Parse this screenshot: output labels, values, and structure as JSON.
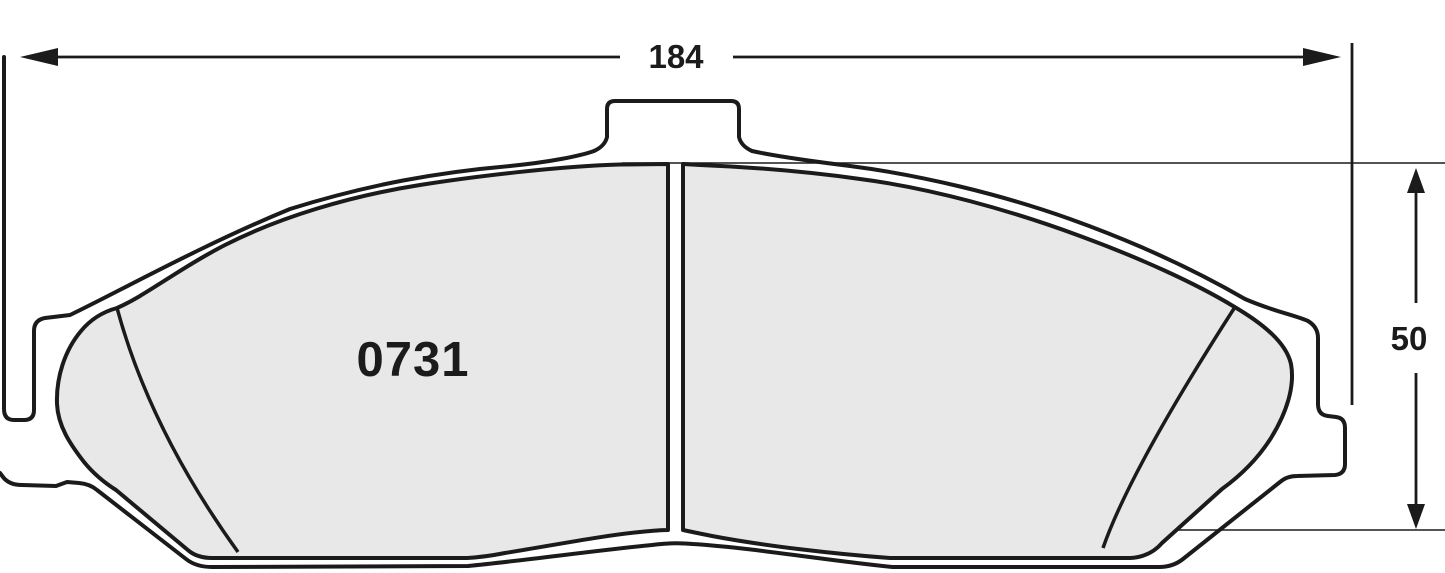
{
  "diagram": {
    "title": "brake-pad-technical-drawing",
    "part_number": "0731",
    "width_dimension": {
      "label": "184"
    },
    "height_dimension": {
      "label": "50"
    }
  },
  "colors": {
    "line": "#1b1b1b",
    "friction_fill": "#e8e8e8",
    "background": "#ffffff",
    "text": "#1b1b1b"
  }
}
